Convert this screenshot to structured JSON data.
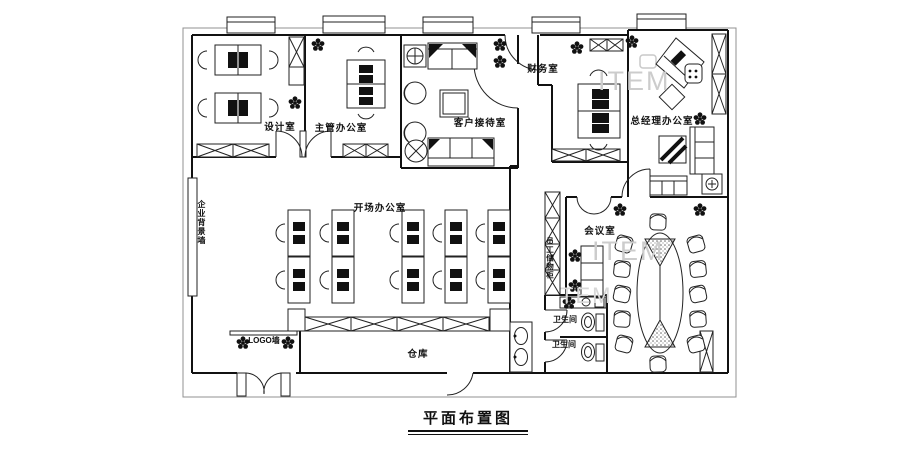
{
  "title": {
    "text": "平面布置图"
  },
  "watermark": {
    "text": "ITEM",
    "text_partial": "TEM"
  },
  "labels": {
    "design_room": "设计室",
    "supervisor_office": "主管办公室",
    "reception_room": "客户接待室",
    "finance_room": "财务室",
    "gm_office": "总经理办公室",
    "open_office": "开场办公室",
    "meeting_room": "会议室",
    "warehouse": "仓库",
    "toilet_upper": "卫生间",
    "toilet_lower": "卫生间",
    "logo_wall": "LOGO墙",
    "background_wall": "企业背景墙",
    "staff_cabinet": "员工储物柜"
  },
  "colors": {
    "line": "#111111",
    "watermark": "#cccccc",
    "paper": "#ffffff"
  }
}
